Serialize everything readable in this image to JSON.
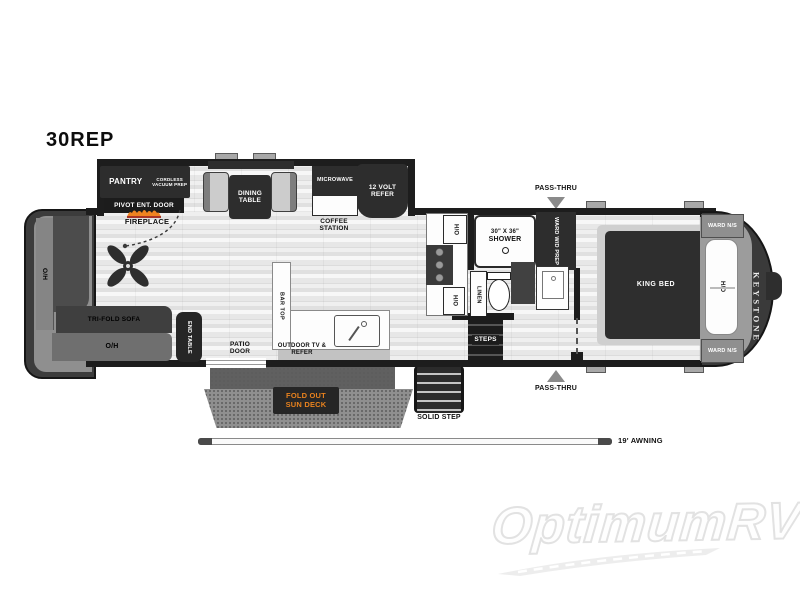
{
  "title": "30REP",
  "watermark": "OptimumRV",
  "floorplan": {
    "living_area": {
      "pantry": "PANTRY",
      "cordless_vacuum_prep": "CORDLESS VACUUM PREP",
      "pivot_ent_door": "PIVOT ENT. DOOR",
      "fireplace": "FIREPLACE",
      "dining_table": "DINING TABLE",
      "overhead_cabinet": "O/H",
      "tri_fold_sofa": "TRI-FOLD SOFA",
      "end_table": "END TABLE",
      "bar_top": "BAR TOP"
    },
    "kitchen": {
      "microwave": "MICROWAVE",
      "twelve_volt_refer": "12 VOLT REFER",
      "coffee_station": "COFFEE STATION",
      "hutch_overhead": "H/O"
    },
    "bathroom": {
      "shower_size": "30\" X 36\"",
      "shower": "SHOWER",
      "ward_wd_prep": "WARD W/D PREP",
      "linen": "LINEN"
    },
    "bedroom": {
      "king_bed": "KING BED",
      "ward_ns": "WARD N/S",
      "headboard_overhead": "H/O",
      "steps": "STEPS",
      "brand_logo": "KEYSTONE"
    },
    "exterior": {
      "pass_thru": "PASS-THRU",
      "patio_door": "PATIO DOOR",
      "outdoor_tv_refer": "OUTDOOR TV & REFER",
      "fold_out_sun_deck": "FOLD OUT SUN DECK",
      "solid_step": "SOLID STEP",
      "awning": "19' AWNING"
    }
  },
  "colors": {
    "wall_black": "#1d1d1d",
    "flame_orange": "#ef8320",
    "sun_deck_text": "#e8821e",
    "watermark_gray": "#e2e2e2"
  }
}
